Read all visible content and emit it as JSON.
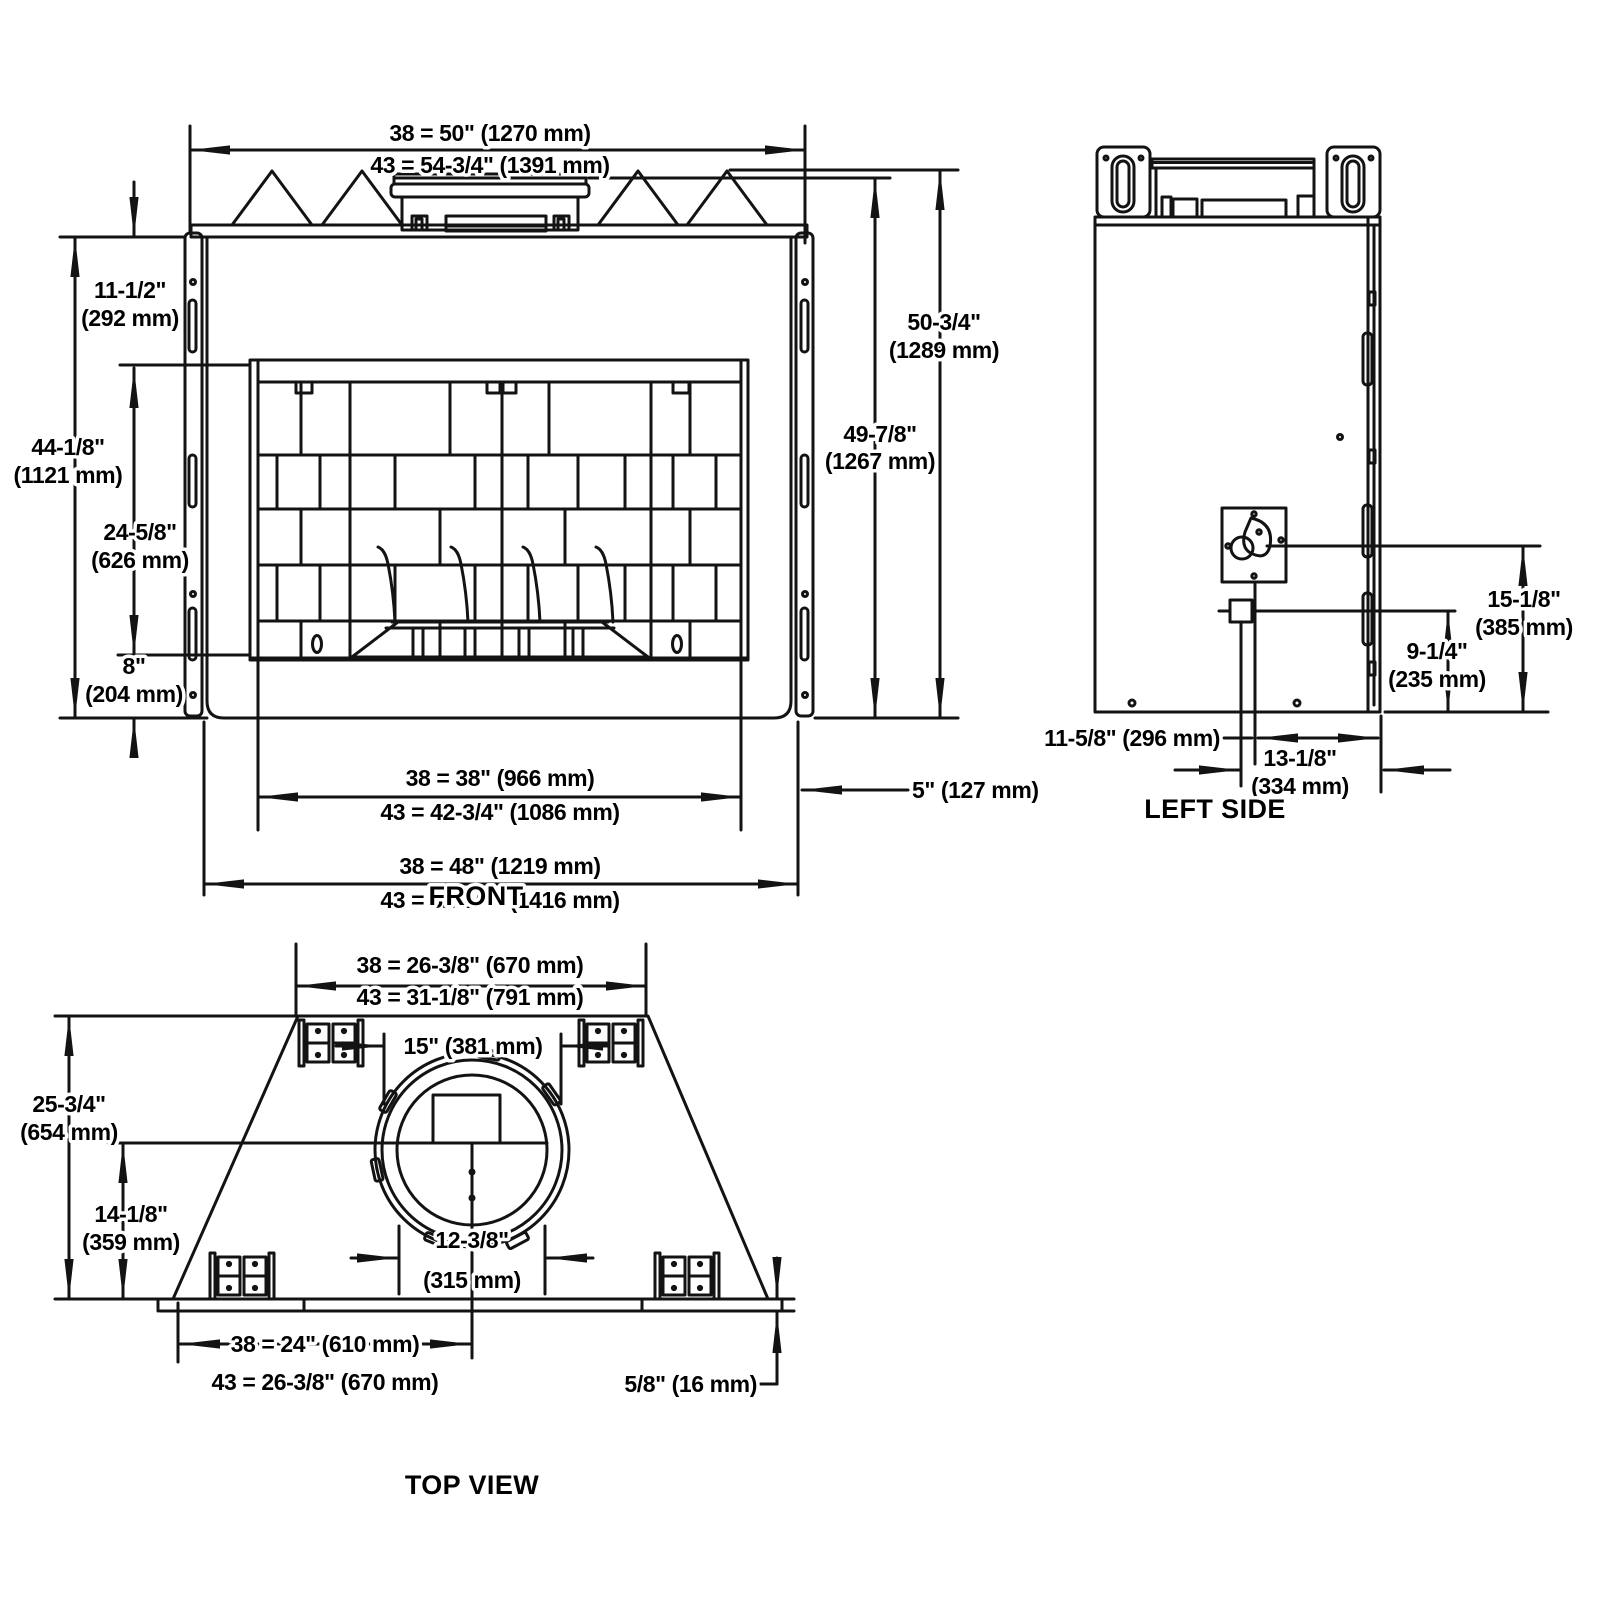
{
  "views": {
    "front": {
      "title": "FRONT",
      "dims": {
        "overall_width_38": "38 = 50\" (1270 mm)",
        "overall_width_43": "43 = 54-3/4\" (1391 mm)",
        "top_height_in": "11-1/2\"",
        "top_height_mm": "(292 mm)",
        "front_height_in": "44-1/8\"",
        "front_height_mm": "(1121 mm)",
        "opening_height_in": "24-5/8\"",
        "opening_height_mm": "(626 mm)",
        "base_height_in": "8\"",
        "base_height_mm": "(204 mm)",
        "height_flue_in": "50-3/4\"",
        "height_flue_mm": "(1289 mm)",
        "height_body_in": "49-7/8\"",
        "height_body_mm": "(1267 mm)",
        "opening_width_38": "38 = 38\" (966 mm)",
        "opening_width_43": "43 = 42-3/4\" (1086 mm)",
        "base_width_38": "38 = 48\" (1219 mm)",
        "base_width_43": "43 = 52-3/4\" (1416 mm)",
        "side_depth": "5\" (127 mm)"
      }
    },
    "left_side": {
      "title": "LEFT SIDE",
      "dims": {
        "valve_height_in": "15-1/8\"",
        "valve_height_mm": "(385 mm)",
        "inlet_height_in": "9-1/4\"",
        "inlet_height_mm": "(235 mm)",
        "back_offset": "11-5/8\" (296 mm)",
        "front_offset_in": "13-1/8\"",
        "front_offset_mm": "(334 mm)"
      }
    },
    "top": {
      "title": "TOP VIEW",
      "dims": {
        "back_width_38": "38 = 26-3/8\" (670 mm)",
        "back_width_43": "43 = 31-1/8\" (791 mm)",
        "flue_outer": "15\" (381 mm)",
        "flue_inner_in": "12-3/8\"",
        "flue_inner_mm": "(315 mm)",
        "depth_in": "25-3/4\"",
        "depth_mm": "(654 mm)",
        "flue_center_in": "14-1/8\"",
        "flue_center_mm": "(359 mm)",
        "half_width_38": "38 = 24\" (610 mm)",
        "half_width_43": "43 = 26-3/8\" (670 mm)",
        "lip": "5/8\" (16 mm)"
      }
    }
  }
}
